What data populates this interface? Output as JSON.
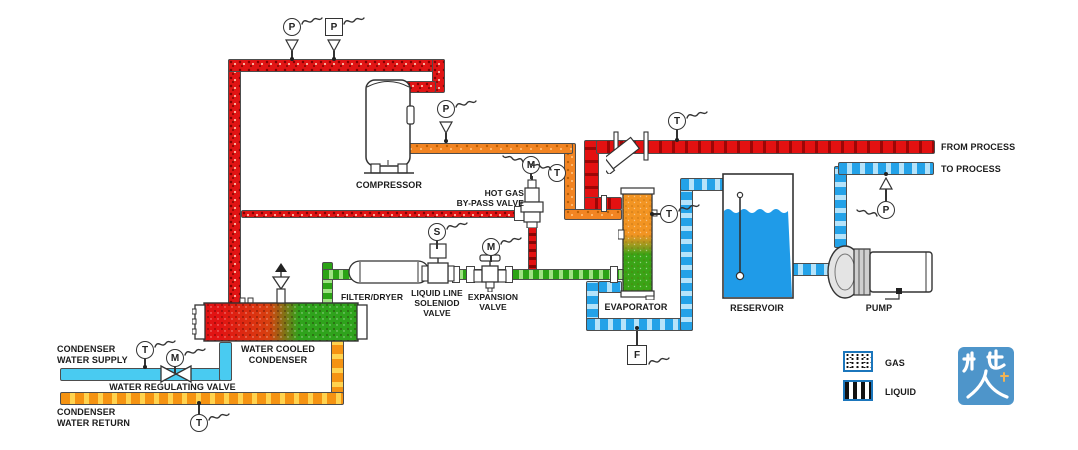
{
  "labels": {
    "compressor": "COMPRESSOR",
    "hot_gas_bypass_1": "HOT GAS",
    "hot_gas_bypass_2": "BY-PASS VALVE",
    "filter_dryer": "FILTER/DRYER",
    "liquid_line_1": "LIQUID LINE",
    "liquid_line_2": "SOLENIOD",
    "liquid_line_3": "VALVE",
    "expansion_1": "EXPANSION",
    "expansion_2": "VALVE",
    "evaporator": "EVAPORATOR",
    "reservoir": "RESERVOIR",
    "pump": "PUMP",
    "from_process": "FROM PROCESS",
    "to_process": "TO PROCESS",
    "condenser_1": "WATER COOLED",
    "condenser_2": "CONDENSER",
    "cond_supply_1": "CONDENSER",
    "cond_supply_2": "WATER SUPPLY",
    "water_reg_valve": "WATER REGULATING VALVE",
    "cond_return_1": "CONDENSER",
    "cond_return_2": "WATER RETURN"
  },
  "instruments": {
    "discharge_pressure_gauge": "P",
    "discharge_pressure_switch": "P",
    "suction_pressure_gauge": "P",
    "hot_gas_valve_motor": "M",
    "suction_temp": "T",
    "solenoid_signal": "S",
    "expansion_valve_motor": "M",
    "process_return_temp": "T",
    "evaporator_temp": "T",
    "process_supply_pressure": "P",
    "flow_switch": "F",
    "supply_water_temp": "T",
    "water_reg_valve_motor": "M",
    "return_water_temp": "T"
  },
  "legend": {
    "gas": "GAS",
    "liquid": "LIQUID"
  },
  "logo": {
    "text": "机电人脉"
  },
  "colors": {
    "hot_gas_red": "#e11414",
    "suction_orange": "#f28422",
    "liquid_green": "#2ba315",
    "chilled_water_blue": "#23a2e8",
    "process_return_red": "#e31111",
    "condenser_supply_cyan": "#49cbf1",
    "condenser_return_orange": "#f59312",
    "legend_border_blue": "#1b76bc",
    "logo_blue": "#4e95ca"
  }
}
